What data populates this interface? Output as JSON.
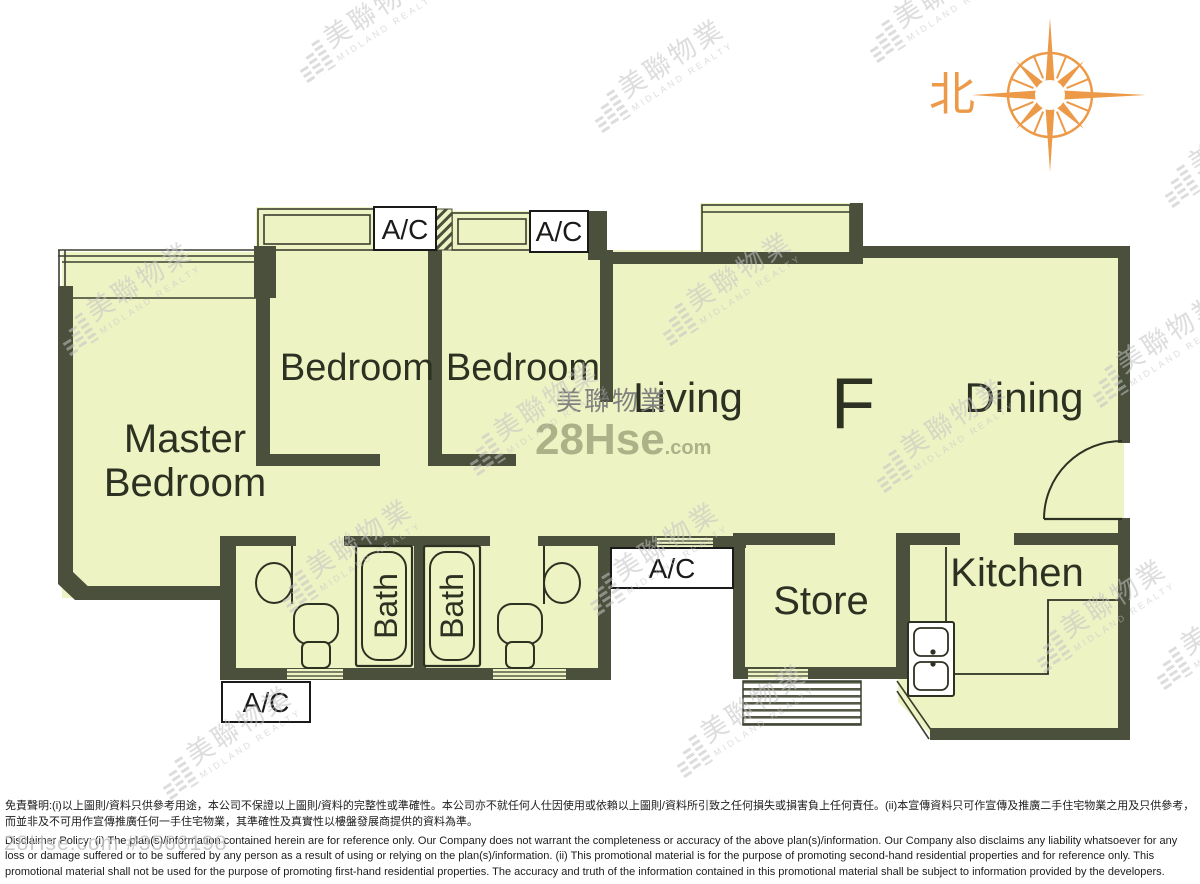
{
  "compass": {
    "north_label": "北"
  },
  "unit": {
    "label": "F"
  },
  "rooms": {
    "master_line1": "Master",
    "master_line2": "Bedroom",
    "bedroom_west": "Bedroom",
    "bedroom_east": "Bedroom",
    "living": "Living",
    "dining": "Dining",
    "kitchen": "Kitchen",
    "store": "Store",
    "bath_west": "Bath",
    "bath_east": "Bath"
  },
  "ac": {
    "top_west": "A/C",
    "top_east": "A/C",
    "bottom_west": "A/C",
    "bottom_middle": "A/C"
  },
  "watermarks": {
    "brand_cn": "美聯物業",
    "brand_en": "MIDLAND REALTY",
    "center_brand": "美聯物業",
    "site_name": "28Hse",
    "site_tld": ".com",
    "listing_ref": "28Hse.com #3566198"
  },
  "disclaimer": {
    "zh": "免責聲明:(i)以上圖則/資料只供參考用途，本公司不保證以上圖則/資料的完整性或準確性。本公司亦不就任何人仕因使用或依賴以上圖則/資料所引致之任何損失或損害負上任何責任。(ii)本宣傳資料只可作宣傳及推廣二手住宅物業之用及只供參考，而並非及不可用作宣傳推廣任何一手住宅物業，其準確性及真實性以樓盤發展商提供的資料為準。",
    "en": "Disclaimer Policy: (i) The plan(s)/information contained herein are for reference only. Our Company does not warrant the completeness or accuracy of the above plan(s)/information. Our Company also disclaims any liability whatsoever for any loss or damage suffered or to be suffered by any person as a result of using or relying on the plan(s)/information. (ii) This promotional material is for the purpose of promoting second-hand residential properties and for reference only. This promotional material shall not be used for the purpose of promoting first-hand residential properties. The accuracy and truth of the information contained in this promotional material shall be subject to information provided by the developers."
  },
  "colors": {
    "room_fill": "#eef3c4",
    "wall": "#4a503c",
    "label": "#2c3122",
    "compass_orange": "#ec9a48",
    "watermark_gray": "#c3c3c3"
  }
}
